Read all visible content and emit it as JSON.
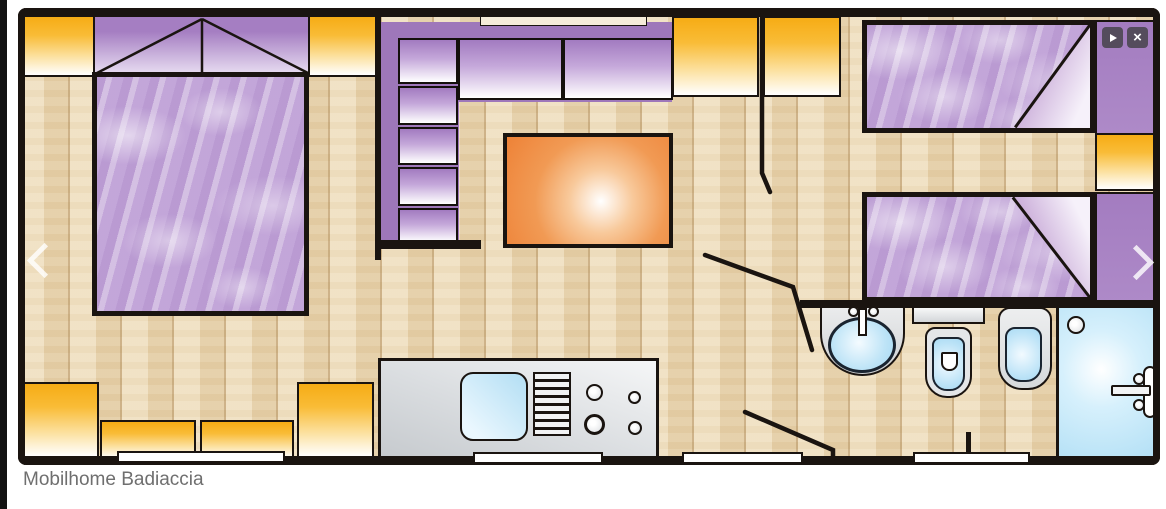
{
  "caption": {
    "title": "Mobilhome Badiaccia"
  },
  "viewer": {
    "prev_button": {
      "icon": "chevron-left-icon"
    },
    "next_button": {
      "icon": "chevron-right-icon"
    },
    "play_button": {
      "icon": "play-icon"
    },
    "close_button": {
      "icon": "close-icon",
      "glyph": "×"
    }
  },
  "floorplan": {
    "kind": "mobile-home floor plan, top view",
    "rooms": [
      "master bedroom",
      "living / kitchen area",
      "twin bedroom",
      "bathroom"
    ],
    "fixtures": [
      "double bed",
      "wardrobes",
      "L-shaped kitchen unit",
      "dining table",
      "sink and hob counter",
      "two single beds",
      "washbasin",
      "toilet",
      "bidet",
      "shower cubicle",
      "windows",
      "door swings"
    ],
    "colors": {
      "floor_wood": "#EAD7B4",
      "wall_black": "#1A1410",
      "cabinet_yellow": "#F8B01F",
      "furniture_purple": "#9E77BA",
      "bed_lilac": "#C6ABDA",
      "table_orange": "#EE8237",
      "water_blue": "#BEE4F7",
      "counter_grey": "#D6D9DC"
    }
  }
}
